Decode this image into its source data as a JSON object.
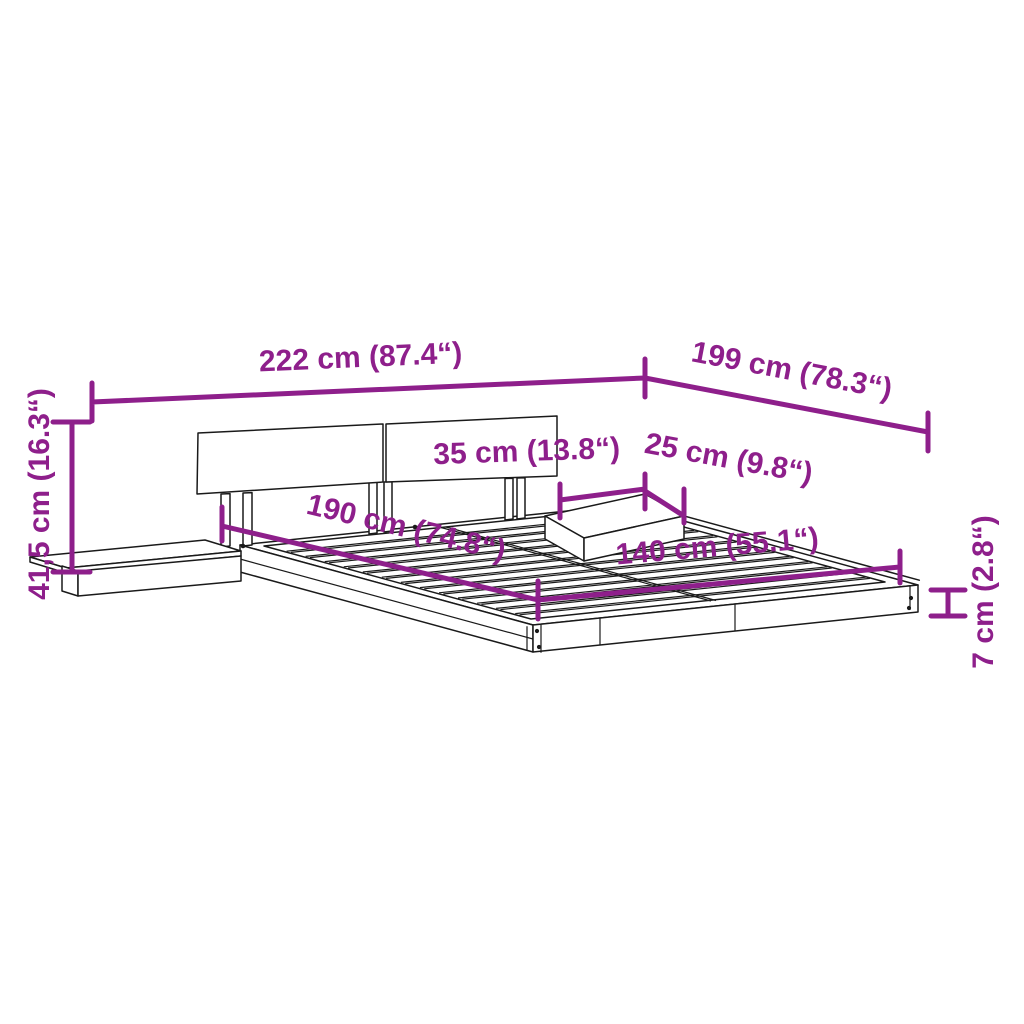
{
  "diagram": {
    "accent_color": "#8E1F8B",
    "line_color": "#1a1a1a",
    "background": "#ffffff",
    "labels": {
      "total_width": "222 cm (87.4“)",
      "total_depth": "199 cm (78.3“)",
      "total_height": "41,5 cm (16.3“)",
      "nightstand_width": "35 cm (13.8“)",
      "nightstand_depth": "25 cm (9.8“)",
      "bed_length": "190 cm (74.8“)",
      "bed_width": "140 cm (55.1“)",
      "frame_height": "7 cm (2.8“)"
    }
  }
}
